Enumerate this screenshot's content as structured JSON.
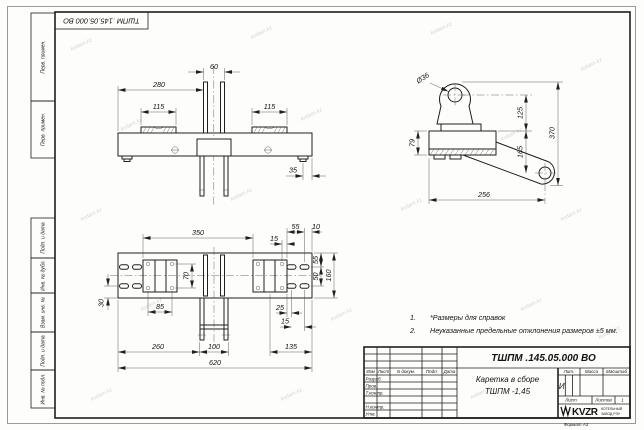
{
  "sheet": {
    "doc_number_top": "ТШПМ .145.05.000  ВО",
    "format_label": "Формат А3",
    "watermark": "kotlam.kz"
  },
  "frame": {
    "top_box1": "Перв. примен.",
    "top_box2": "Перв. примен.",
    "bottom_box1": "Подп. и дата",
    "bottom_box2": "Инв. № дубл.",
    "bottom_box3": "Взам. инв. №",
    "bottom_box4": "Подп. и дата",
    "bottom_box5": "Инв. № подл."
  },
  "notes": {
    "item1_num": "1.",
    "item1_text": "*Размеры для справок",
    "item2_num": "2.",
    "item2_text": "Неуказанные предельные отклонения размеров  ±5 мм."
  },
  "title_block": {
    "doc_number": "ТШПМ .145.05.000  ВО",
    "part_name_line1": "Каретка в сборе",
    "part_name_line2": "ТШПМ -1,45",
    "col_izm": "Изм",
    "col_list": "Лист",
    "col_ndoc": "N докум.",
    "col_podp": "Подп.",
    "col_data": "Дата",
    "row_razrab": "Разраб.",
    "row_prov": "Пров.",
    "row_tkontr": "Т.контр.",
    "row_nkontr": "Н.контр.",
    "row_utv": "Утв.",
    "lit_label": "Лит.",
    "mass_label": "Масса",
    "scale_label": "Масштаб",
    "lit_value": "И",
    "sheet_label": "Лист",
    "sheets_label": "Листов",
    "sheets_value": "1",
    "logo_text": "KVZR",
    "logo_sub_line1": "КОТЕЛЬНЫЙ",
    "logo_sub_line2": "ЗАВОД РЭУ"
  },
  "dims": {
    "front": {
      "d60": "60",
      "d280": "280",
      "d115_left": "115",
      "d115_right": "115",
      "d35": "35"
    },
    "side": {
      "dia36": "Ø36",
      "d125": "125",
      "d165": "165",
      "d370": "370",
      "d79": "79",
      "d256": "256"
    },
    "plan": {
      "d350": "350",
      "d15_top": "15",
      "d55_top": "55",
      "d10": "10",
      "d70": "70",
      "d85": "85",
      "d30": "30",
      "d25": "25",
      "d15_bottom": "15",
      "d135": "135",
      "d260": "260",
      "d100": "100",
      "d620": "620",
      "d55_right": "55",
      "d50_right": "50",
      "d160": "160"
    }
  }
}
